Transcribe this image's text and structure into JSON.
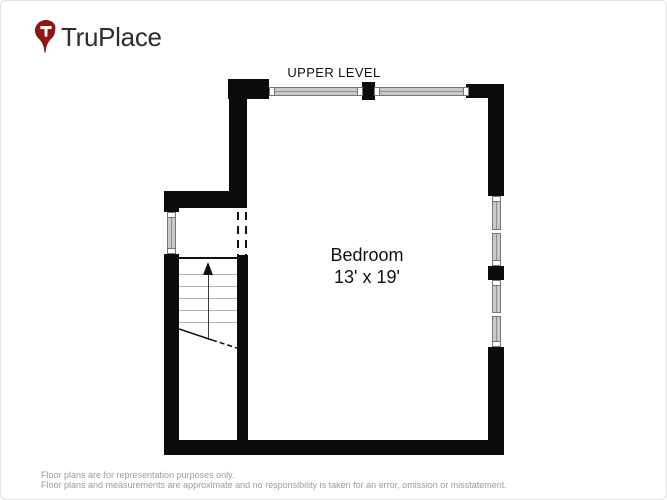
{
  "page": {
    "background": "#ffffff",
    "border_color": "#e3e3e3"
  },
  "header": {
    "brand": "TruPlace",
    "pin_color": "#8e1616",
    "pin_letter": "T",
    "text_color": "#2d2d2d"
  },
  "floor_plan": {
    "level_label": "UPPER LEVEL",
    "room": {
      "name": "Bedroom",
      "dimensions": "13' x 19'"
    },
    "stairs": {
      "direction": "up",
      "tread_count": 5
    },
    "colors": {
      "wall": "#0b0b0b",
      "window_fill": "#c9c9c9",
      "window_frame": "#767676"
    }
  },
  "footer": {
    "line1": "Floor plans are for representation purposes only.",
    "line2": "Floor plans and measurements are approximate and no responsibility is taken for an error, omission or misstatement."
  }
}
